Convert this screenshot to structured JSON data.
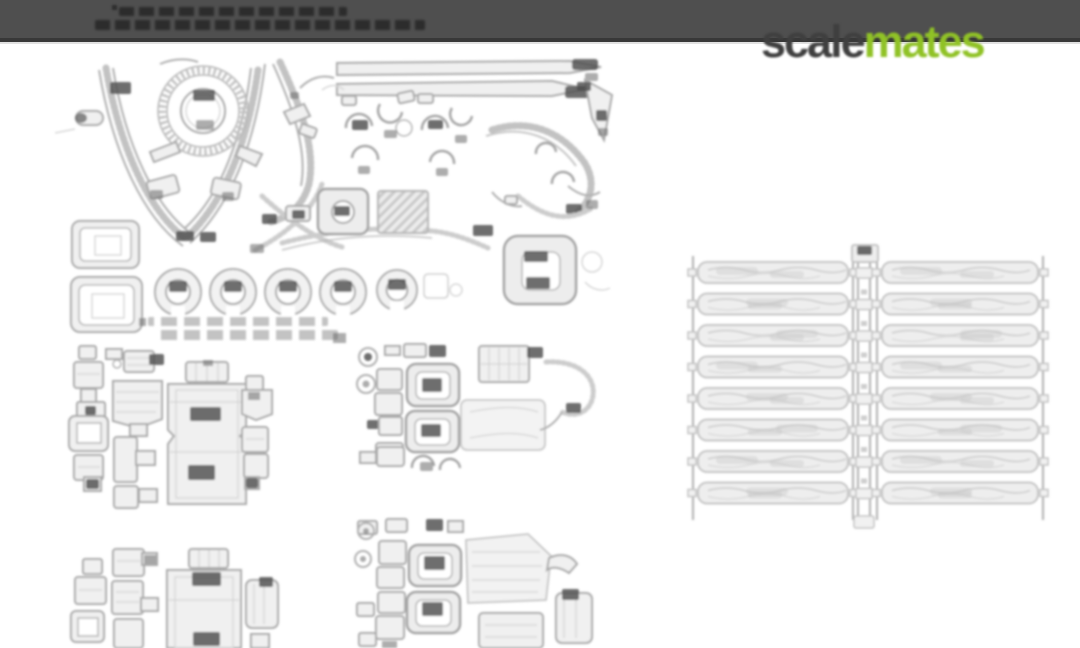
{
  "banner": {
    "bg": "#4f4f4f",
    "border": "#383838",
    "note_lines": 2
  },
  "watermark": {
    "scale": "scale",
    "mates": "mates",
    "scale_color": "#3f3f3f",
    "mates_color": "#90c226"
  },
  "sheet": {
    "paper": "#ffffff",
    "ink": "#a9a9a9",
    "ink_light": "#c9c9c9",
    "label_color": "#4e4e4e",
    "groups": [
      "fret-top-left",
      "cluster-mid-left",
      "cluster-mid-center",
      "cluster-bottom-left",
      "cluster-bottom-center",
      "louver-grille-right"
    ],
    "ring_row": {
      "cy": 292,
      "r": 23,
      "centers": [
        178,
        233,
        288,
        343
      ],
      "small": {
        "cx": 397,
        "r": 20
      }
    },
    "grille": {
      "y": 262,
      "rows": 8,
      "pitch": 31.5,
      "bar_h": 21,
      "mid_x": 856,
      "panels": [
        {
          "x": 690,
          "w": 166
        },
        {
          "x": 874,
          "w": 172
        }
      ]
    }
  }
}
